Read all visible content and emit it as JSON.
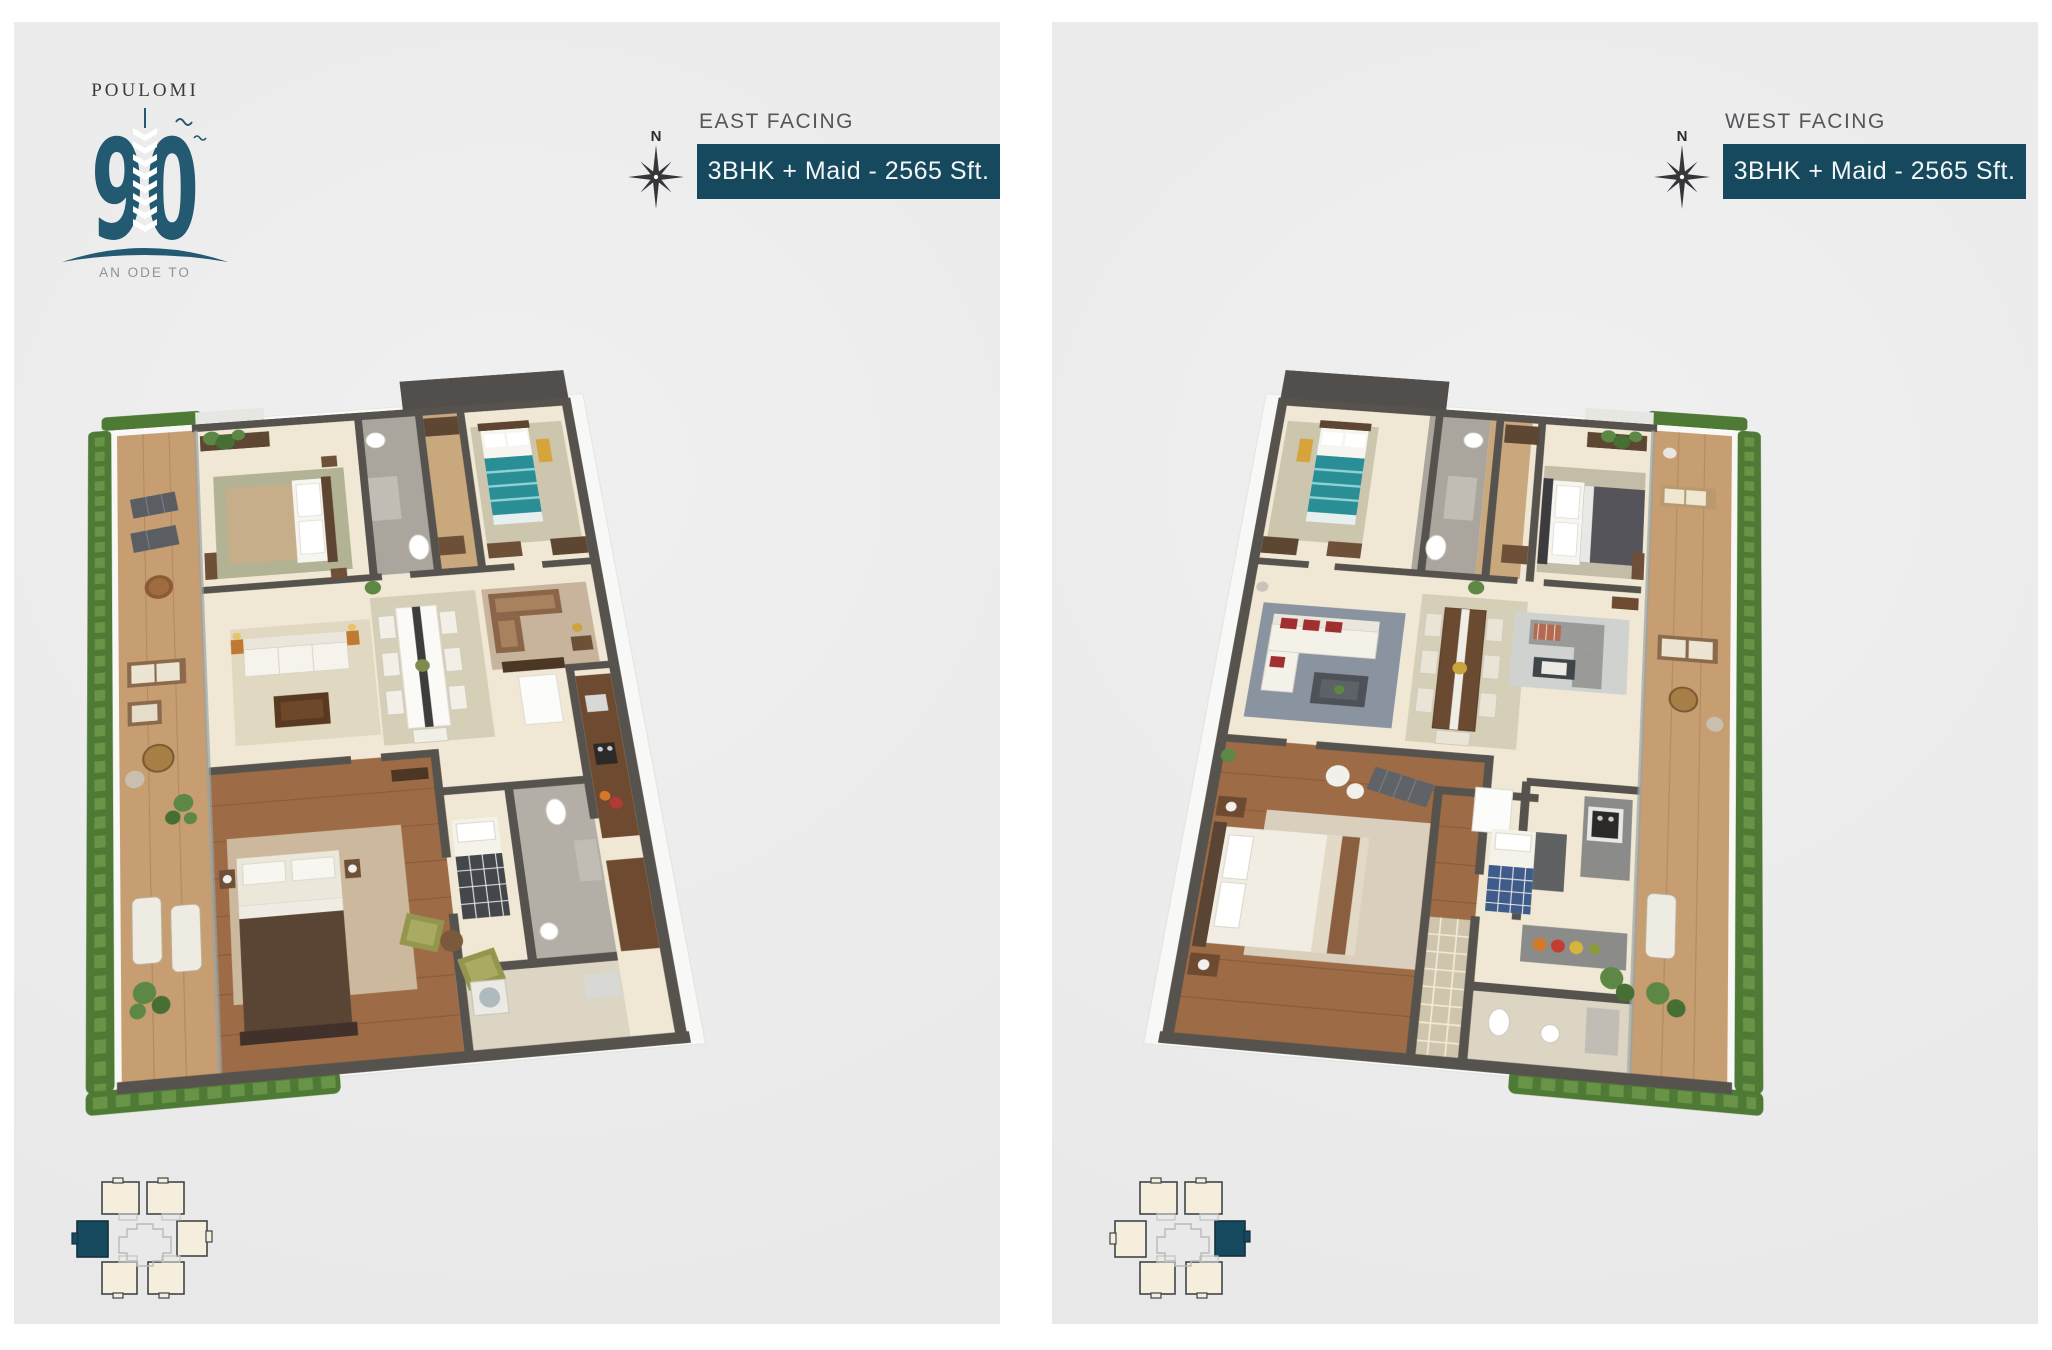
{
  "logo": {
    "brand": "POULOMI",
    "number": "90",
    "tagline_line1": "AN ODE TO",
    "tagline_line2": "PERFECTION."
  },
  "panels": [
    {
      "id": "east",
      "facing_label": "EAST FACING",
      "spec": "3BHK + Maid - 2565 Sft.",
      "compass_north": "N",
      "locator_highlight": "left-middle-unit"
    },
    {
      "id": "west",
      "facing_label": "WEST FACING",
      "spec": "3BHK + Maid - 2565 Sft.",
      "compass_north": "N",
      "locator_highlight": "right-middle-unit"
    }
  ],
  "theme": {
    "teal": "#17495e",
    "logo_teal": "#235a72",
    "panel_bg": "#ececec",
    "text_gray": "#55565a",
    "floor_cream": "#f0e8d4",
    "wall_gray": "#56524e",
    "hedge_green": "#4e7a36",
    "wood_brown": "#9d6c46",
    "locator_cream": "#f6eedd"
  }
}
